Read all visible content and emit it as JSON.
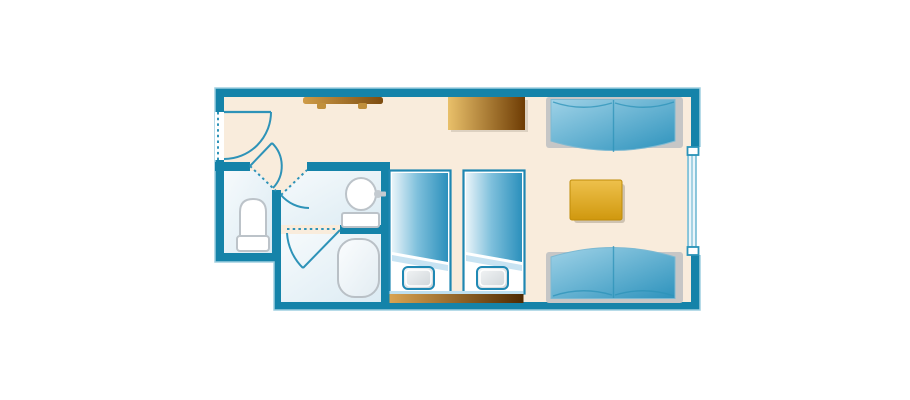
{
  "meta": {
    "description": "Hotel guest room floor plan, top-down view, no text labels",
    "type": "floor-plan"
  },
  "colors": {
    "wall": "#1583a9",
    "wallOutline": "#9fcfe0",
    "floor": "#f9ecdc",
    "bathFloorLight": "#f6fafc",
    "bathFloorDark": "#dcebf3",
    "line": "#2e93b8",
    "lightLine": "#bfe0ef",
    "sofaFrame": "#c6c6c6",
    "fixtureStroke": "#bcc3c9",
    "duvetLight": "#e9f4f9",
    "duvetDark": "#2b90bc",
    "cushionLight": "#9fd2e7",
    "cushionDark": "#2e93bd",
    "pillowLight": "#f5f7f8",
    "pillowDark": "#cdd3d7",
    "pillowBorder": "#2089b4",
    "tableGoldLight": "#eec14c",
    "tableGoldDark": "#d0980e",
    "dresserLight": "#e9c06a",
    "dresserDark": "#6e3c04",
    "headboardLight": "#d9a452",
    "headboardDark": "#4e2a02",
    "hangerLight": "#cf9c48",
    "hangerDark": "#7d4c10"
  },
  "floorplan": {
    "rooms": [
      {
        "name": "entryway"
      },
      {
        "name": "toilet-room"
      },
      {
        "name": "washroom"
      },
      {
        "name": "bathroom"
      },
      {
        "name": "main-bedroom"
      }
    ],
    "furniture": [
      {
        "name": "coat-rack"
      },
      {
        "name": "dresser"
      },
      {
        "name": "sofa-top"
      },
      {
        "name": "sofa-bottom"
      },
      {
        "name": "table"
      },
      {
        "name": "bed-1"
      },
      {
        "name": "bed-2"
      },
      {
        "name": "headboard"
      },
      {
        "name": "toilet"
      },
      {
        "name": "sink"
      },
      {
        "name": "vanity-counter"
      },
      {
        "name": "bathtub"
      }
    ],
    "features": [
      {
        "name": "entrance-door"
      },
      {
        "name": "vestibule-door"
      },
      {
        "name": "washroom-door"
      },
      {
        "name": "bathroom-door"
      },
      {
        "name": "window"
      }
    ]
  }
}
